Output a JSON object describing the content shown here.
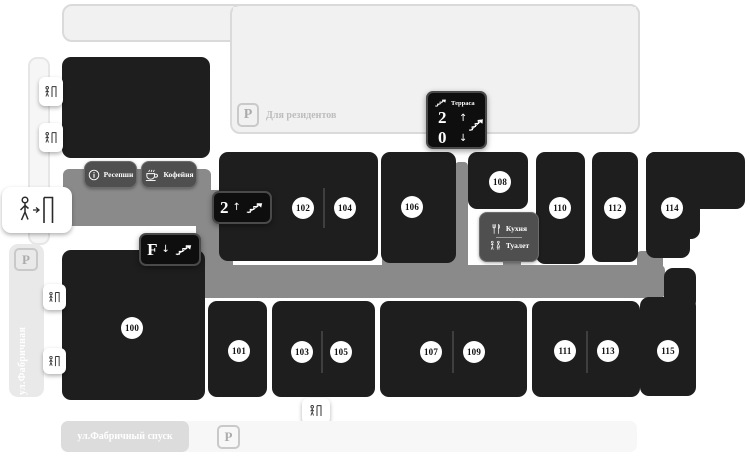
{
  "streets": {
    "left": "ул.Фабричная",
    "bottom": "ул.Фабричный спуск"
  },
  "residents": {
    "label": "Для резидентов",
    "parking": "P"
  },
  "parking": {
    "left": "P",
    "bottom": "P"
  },
  "rooms": [
    {
      "number": "100"
    },
    {
      "number": "101"
    },
    {
      "number": "102"
    },
    {
      "number": "103"
    },
    {
      "number": "104"
    },
    {
      "number": "105"
    },
    {
      "number": "106"
    },
    {
      "number": "107"
    },
    {
      "number": "108"
    },
    {
      "number": "109"
    },
    {
      "number": "110"
    },
    {
      "number": "111"
    },
    {
      "number": "112"
    },
    {
      "number": "113"
    },
    {
      "number": "114"
    },
    {
      "number": "115"
    }
  ],
  "badges": {
    "floor2": {
      "value": "2",
      "arrow": "↑"
    },
    "floorF": {
      "value": "F",
      "arrow": "↓"
    },
    "terrace": {
      "title": "Терраса",
      "up": "2",
      "up_arrow": "↑",
      "down": "0",
      "down_arrow": "↓"
    }
  },
  "amenities": {
    "reception": "Ресепшн",
    "coffee": "Кофейня",
    "kitchen": "Кухня",
    "toilet": "Туалет"
  },
  "icons": {
    "stairs": "stairs-with-arrow",
    "door": "person-at-door",
    "entrance": "person-walking-to-door",
    "info": "circled-i",
    "coffee": "steaming-cup",
    "kitchen": "fork-and-knife",
    "toilet": "wc-figures",
    "parking": "letter-P"
  },
  "colors": {
    "room_block": "#1e1e1e",
    "corridor": "#8a8a8a",
    "label_box": "#4f4f4f",
    "area_fill": "#f1f1f1"
  }
}
